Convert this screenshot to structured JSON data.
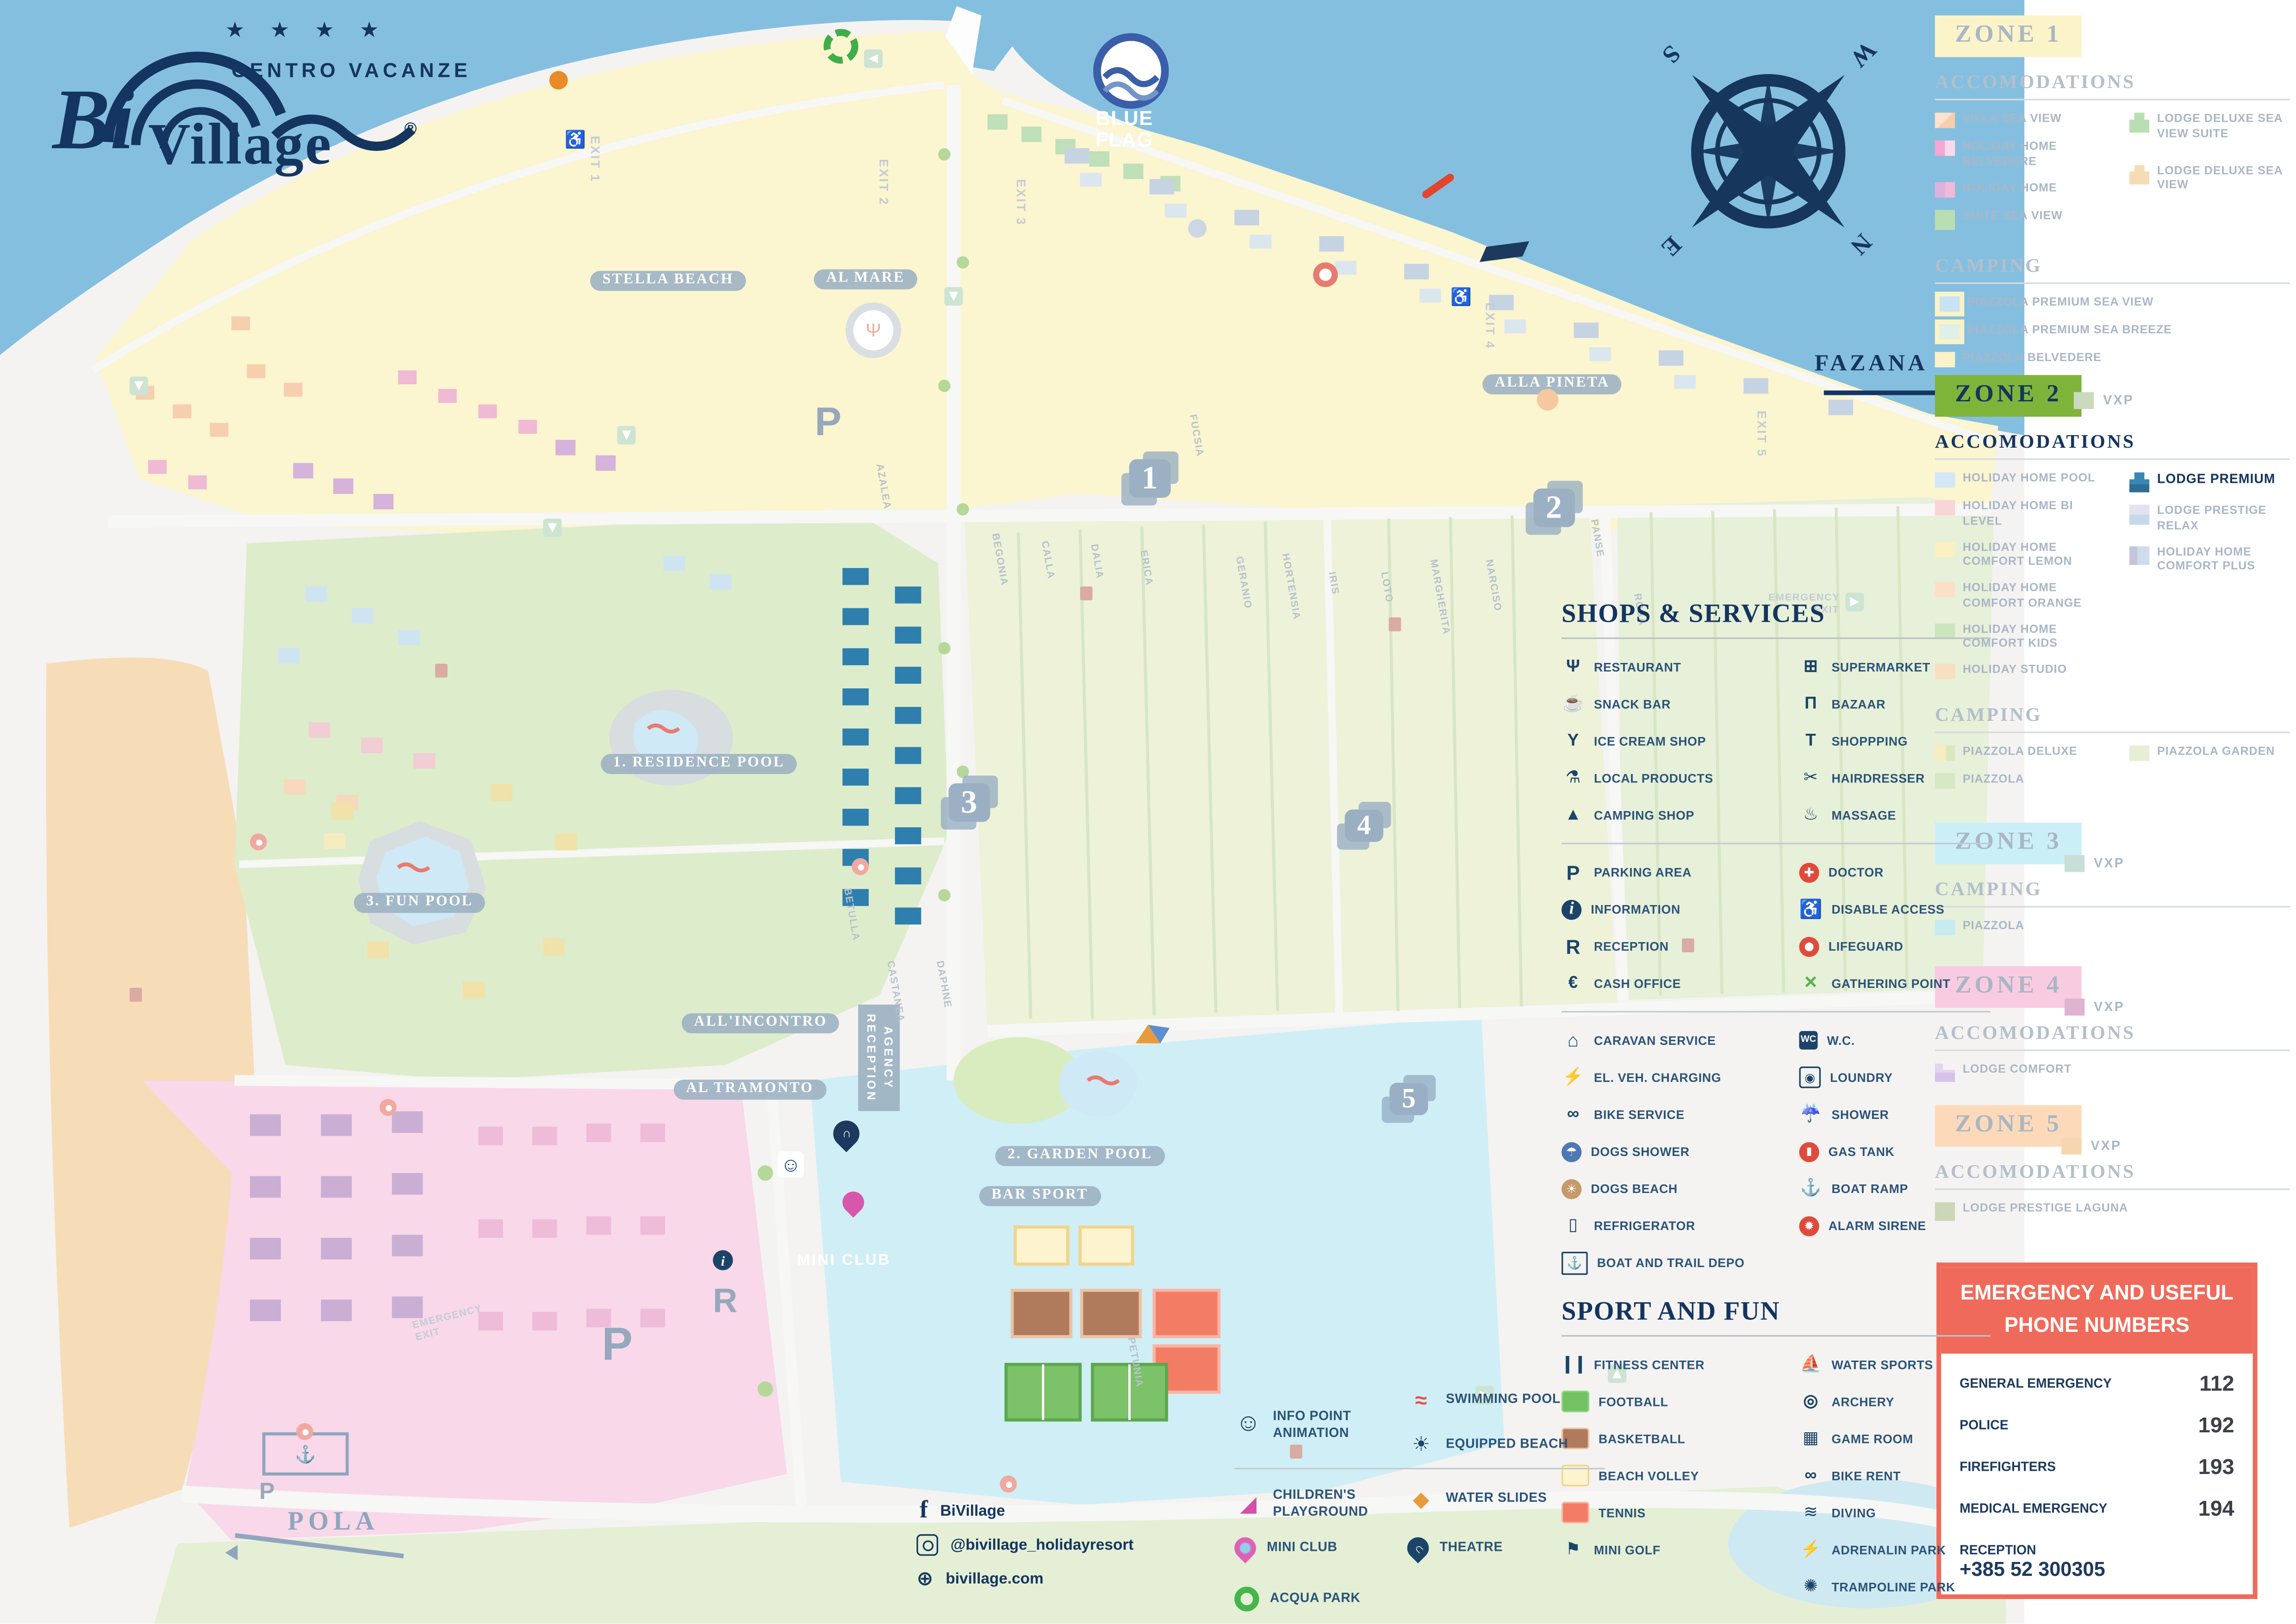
{
  "logo": {
    "bi": "Bi",
    "village": "Village",
    "reg": "®",
    "stars": "★ ★ ★ ★",
    "subtitle": "CENTRO VACANZE"
  },
  "blue_flag": {
    "line1": "BLUE",
    "line2": "FLAG"
  },
  "compass": {
    "n": "N",
    "s": "S",
    "e": "E",
    "w": "W"
  },
  "fazana": "FAZANA",
  "pola": "POLA",
  "map": {
    "labels": {
      "stella_beach": "STELLA BEACH",
      "al_mare": "AL MARE",
      "alla_pineta": "ALLA PINETA",
      "residence_pool": "1. RESIDENCE POOL",
      "garden_pool": "2. GARDEN POOL",
      "fun_pool": "3. FUN POOL",
      "all_incontro": "ALL'INCONTRO",
      "al_tramonto": "AL TRAMONTO",
      "bar_sport": "BAR SPORT",
      "mini_club": "MINI CLUB",
      "agency_line1": "AGENCY",
      "agency_line2": "RECEPTION"
    },
    "exits": [
      "EXIT 1",
      "EXIT 2",
      "EXIT 3",
      "EXIT 4",
      "EXIT 5"
    ],
    "emergency_exit_1": "EMERGENCY",
    "emergency_exit_2": "EXIT",
    "zone_markers": [
      "1",
      "2",
      "3",
      "4",
      "5"
    ],
    "letters": {
      "p": "P",
      "r": "R",
      "i": "i"
    },
    "icons": {
      "wheelchair": "♿",
      "smiley": "☺",
      "theatre": "∩",
      "depo": "⚓",
      "almare": "Ψ"
    },
    "streets": [
      "AZALEA",
      "BEGONIA",
      "CALLA",
      "DALIA",
      "ERICA",
      "FUCSIA",
      "GERANIO",
      "HORTENSIA",
      "IRIS",
      "LOTO",
      "MARGHERITA",
      "NARCISO",
      "PANSE",
      "ROSA",
      "BETULLA",
      "CASTANEA",
      "DAPHNE",
      "PETUNIA"
    ]
  },
  "zones": [
    {
      "title": "ZONE 1",
      "tstyle": "background:#fbf4c9;color:#a9b6c6",
      "h1": "ACCOMODATIONS",
      "h2": "CAMPING",
      "colA": [
        {
          "label": "VILLA SEA VIEW",
          "sw": "background:linear-gradient(135deg,#fbe3d0 50%,#f6cfae 50%)"
        },
        {
          "label": "HOLIDAY HOME BELVEDERE",
          "sw": "background:linear-gradient(90deg,#f4a7d4 50%,#fbd9ec 50%)"
        },
        {
          "label": "HOLIDAY HOME",
          "sw": "background:linear-gradient(90deg,#d9b3dd 50%,#f2b9d8 50%)"
        },
        {
          "label": "SUITE SEA VIEW",
          "sw": "background:#b9deb3;height:13px"
        }
      ],
      "colB": [
        {
          "label": "LODGE DELUXE SEA VIEW SUITE",
          "sw": "background:#b9deb3;height:13px;clip-path:polygon(25% 0,75% 0,75% 35%,100% 35%,100% 100%,0 100%,0 35%,25% 35%)"
        },
        {
          "label": "LODGE DELUXE SEA VIEW",
          "sw": "background:#f6dcb4;height:13px;clip-path:polygon(25% 0,75% 0,75% 35%,100% 35%,100% 100%,0 100%,0 35%,25% 35%)"
        }
      ],
      "campA": [
        {
          "label": "PIAZZOLA PREMIUM SEA VIEW",
          "sw": "background:#c9e3f2;box-shadow:0 0 0 3px #faf3c8;margin-left:3px"
        },
        {
          "label": "PIAZZOLA PREMIUM SEA BREEZE",
          "sw": "background:#e0efe7;box-shadow:0 0 0 3px #faf3c8;margin-left:3px"
        },
        {
          "label": "PIAZZOLA BELVEDERE",
          "sw": "background:#faf3c8"
        }
      ]
    },
    {
      "title": "ZONE 2",
      "tstyle": "background:#7fb43b;color:#14355f",
      "vxp": "VXP",
      "vxp_sw": "background:#cbd9bd",
      "h1": "ACCOMODATIONS",
      "h2": "CAMPING",
      "colA": [
        {
          "label": "HOLIDAY HOME POOL",
          "sw": "background:#d3e8f6"
        },
        {
          "label": "HOLIDAY HOME BI LEVEL",
          "sw": "background:#f6d6d6"
        },
        {
          "label": "HOLIDAY HOME COMFORT LEMON",
          "sw": "background:#f9f1c4"
        },
        {
          "label": "HOLIDAY HOME COMFORT ORANGE",
          "sw": "background:#fce0c6"
        },
        {
          "label": "HOLIDAY HOME COMFORT KIDS",
          "sw": "background:#cbe5bd"
        },
        {
          "label": "HOLIDAY STUDIO",
          "sw": "background:#f8dfc2"
        }
      ],
      "colB": [
        {
          "label": "LODGE PREMIUM",
          "lstyle": "color:#14355f;font-size:8.5px",
          "sw": "background:linear-gradient(#3787b4 60%,#2d6f94 60%);height:13px;clip-path:polygon(25% 0,75% 0,75% 35%,100% 35%,100% 100%,0 100%,0 35%,25% 35%)"
        },
        {
          "label": "LODGE PRESTIGE RELAX",
          "sw": "background:linear-gradient(#e2e2f0 50%,#c6d9e8 50%);height:13px"
        },
        {
          "label": "HOLIDAY HOME COMFORT PLUS",
          "sw": "background:linear-gradient(90deg,#c5c5da 40%,#cfdcec 40%);height:12px"
        }
      ],
      "campA": [
        {
          "label": "PIAZZOLA DELUXE",
          "sw": "background:linear-gradient(90deg,#f7edc0 55%,#d8e9c0 55%)"
        },
        {
          "label": "PIAZZOLA",
          "sw": "background:#d5e8c3"
        }
      ],
      "campB": [
        {
          "label": "PIAZZOLA GARDEN",
          "sw": "background:#e6efd4"
        }
      ]
    },
    {
      "title": "ZONE 3",
      "tstyle": "background:#cbeff6;color:#a9b6c6",
      "vxp": "VXP",
      "vxp_sw": "background:#c7ded9",
      "h2": "CAMPING",
      "campA": [
        {
          "label": "PIAZZOLA",
          "sw": "background:#c6ebf1"
        }
      ]
    },
    {
      "title": "ZONE 4",
      "tstyle": "background:#f9cbe1;color:#a9b6c6",
      "vxp": "VXP",
      "vxp_sw": "background:#dfb3d2",
      "h1": "ACCOMODATIONS",
      "colA": [
        {
          "label": "LODGE COMFORT",
          "sw": "background:linear-gradient(#e4d4ee 50%,#d6c2e8 50%);height:12px;clip-path:polygon(0 0,40% 0,40% 35%,100% 35%,100% 100%,0 100%)"
        }
      ]
    },
    {
      "title": "ZONE 5",
      "tstyle": "background:#fcdab9;color:#a9b6c6",
      "vxp": "VXP",
      "vxp_sw": "background:#f6d6ae",
      "h1": "ACCOMODATIONS",
      "colA": [
        {
          "label": "LODGE PRESTIGE LAGUNA",
          "sw": "background:#ccd6b8;height:12px"
        }
      ]
    }
  ],
  "services": {
    "title": "SHOPS & SERVICES",
    "g1a": [
      {
        "label": "RESTAURANT",
        "glyph": "Ψ",
        "ic": "font-weight:700"
      },
      {
        "label": "SNACK BAR",
        "glyph": "☕"
      },
      {
        "label": "ICE CREAM SHOP",
        "glyph": "Y",
        "ic": "font-weight:900"
      },
      {
        "label": "LOCAL PRODUCTS",
        "glyph": "⚗"
      },
      {
        "label": "CAMPING SHOP",
        "glyph": "▲"
      }
    ],
    "g1b": [
      {
        "label": "SUPERMARKET",
        "glyph": "⊞",
        "ic": "font-weight:700"
      },
      {
        "label": "BAZAAR",
        "glyph": "Π",
        "ic": "font-weight:900"
      },
      {
        "label": "SHOPPPING",
        "glyph": "T",
        "ic": "font-weight:900"
      },
      {
        "label": "HAIRDRESSER",
        "glyph": "✂"
      },
      {
        "label": "MASSAGE",
        "glyph": "♨"
      }
    ],
    "g2a": [
      {
        "label": "PARKING AREA",
        "glyph": "P",
        "ic": "font-weight:900;font-size:13px"
      },
      {
        "label": "INFORMATION",
        "glyph": "i",
        "ic": "background:#1c4468;color:#fff;border-radius:50%;font-family:'Liberation Serif',serif;font-style:italic;font-weight:700;width:13px;flex-basis:13px"
      },
      {
        "label": "RECEPTION",
        "glyph": "R",
        "ic": "font-weight:900;font-size:13px"
      },
      {
        "label": "CASH OFFICE",
        "glyph": "€",
        "ic": "font-weight:900"
      }
    ],
    "g2b": [
      {
        "label": "DOCTOR",
        "glyph": "✚",
        "ic": "background:#df4b3b;color:#fff;border-radius:50%;font-size:8px;width:13px;flex-basis:13px"
      },
      {
        "label": "DISABLE ACCESS",
        "glyph": "♿",
        "ic": "font-size:12px"
      },
      {
        "label": "LIFEGUARD",
        "glyph": "",
        "ic": "background:radial-gradient(#ffffff 0 30%,#df4b3b 31%);border-radius:50%;width:13px;flex-basis:13px;height:13px"
      },
      {
        "label": "GATHERING POINT",
        "glyph": "✕",
        "ic": "color:#57b44c;font-weight:900"
      }
    ],
    "g3a": [
      {
        "label": "CARAVAN SERVICE",
        "glyph": "⌂",
        "ic": "font-weight:900;font-size:12px"
      },
      {
        "label": "EL. VEH. CHARGING",
        "glyph": "⚡"
      },
      {
        "label": "BIKE SERVICE",
        "glyph": "∞",
        "ic": "font-weight:900"
      },
      {
        "label": "DOGS SHOWER",
        "glyph": "☂",
        "ic": "background:#5077b4;color:#fff;border-radius:50%;font-size:8px;width:13px;flex-basis:13px;height:13px"
      },
      {
        "label": "DOGS BEACH",
        "glyph": "☀",
        "ic": "background:#c79a6b;color:#fff;border-radius:50%;font-size:8px;width:13px;flex-basis:13px;height:13px"
      },
      {
        "label": "REFRIGERATOR",
        "glyph": "▯"
      },
      {
        "label": "BOAT AND TRAIL DEPO",
        "glyph": "⚓",
        "ic": "border:1.5px solid #1c4468;font-size:8px;border-radius:1px"
      }
    ],
    "g3b": [
      {
        "label": "W.C.",
        "glyph": "WC",
        "ic": "background:#1c4468;color:#fff;font-size:6px;font-weight:700;border-radius:2px;width:12px;flex-basis:12px;height:12px"
      },
      {
        "label": "LOUNDRY",
        "glyph": "◉",
        "ic": "border:1.5px solid #1c4468;font-size:8px;border-radius:2px;width:12px;flex-basis:12px;height:12px"
      },
      {
        "label": "SHOWER",
        "glyph": "☔"
      },
      {
        "label": "GAS TANK",
        "glyph": "▮",
        "ic": "background:#df4b3b;color:#fff;border-radius:50%;font-size:7px;width:13px;flex-basis:13px;height:13px"
      },
      {
        "label": "BOAT RAMP",
        "glyph": "⚓"
      },
      {
        "label": "ALARM SIRENE",
        "glyph": "✹",
        "ic": "background:#df4b3b;color:#fff;border-radius:50%;font-size:8px;width:13px;flex-basis:13px;height:13px"
      }
    ]
  },
  "sport": {
    "title": "SPORT AND FUN",
    "a": [
      {
        "label": "FITNESS CENTER",
        "glyph": "❙❙",
        "ic": "font-weight:900;letter-spacing:-1px"
      },
      {
        "label": "FOOTBALL",
        "glyph": "",
        "ic": "background:#72c162;border:1.5px solid #8ed47f;border-radius:2px;width:16px;flex-basis:16px;height:12px"
      },
      {
        "label": "BASKETBALL",
        "glyph": "",
        "ic": "background:#b07a5c;border:1.5px solid #eac3a6;border-radius:2px;width:16px;flex-basis:16px;height:12px"
      },
      {
        "label": "BEACH VOLLEY",
        "glyph": "",
        "ic": "background:#fdf3cf;border:1.5px solid #f0d488;border-radius:2px;width:16px;flex-basis:16px;height:12px"
      },
      {
        "label": "TENNIS",
        "glyph": "",
        "ic": "background:#f37d64;border:1.5px solid #f8b5a5;border-radius:2px;width:16px;flex-basis:16px;height:12px"
      },
      {
        "label": "MINI GOLF",
        "glyph": "⚑"
      }
    ],
    "b": [
      {
        "label": "WATER SPORTS",
        "glyph": "⛵"
      },
      {
        "label": "ARCHERY",
        "glyph": "◎",
        "ic": "font-weight:900"
      },
      {
        "label": "GAME ROOM",
        "glyph": "▦"
      },
      {
        "label": "BIKE RENT",
        "glyph": "∞",
        "ic": "font-weight:900"
      },
      {
        "label": "DIVING",
        "glyph": "≋"
      },
      {
        "label": "ADRENALIN PARK",
        "glyph": "⚡"
      },
      {
        "label": "TRAMPOLINE PARK",
        "glyph": "✺"
      }
    ]
  },
  "fun": {
    "a": [
      {
        "label": "INFO POINT ANIMATION",
        "glyph": "☺",
        "ic": "font-size:16px"
      },
      {
        "label": "CHILDREN'S PLAYGROUND",
        "glyph": "◢",
        "ic": "color:#d64fa8;font-size:14px"
      },
      {
        "label": "MINI CLUB",
        "glyph": "",
        "ic": "background:radial-gradient(#8fd0e8 0 3px,#e060b8 4px);border-radius:50% 50% 50% 0;transform:rotate(-45deg);width:14px;flex-basis:14px;height:14px"
      },
      {
        "label": "ACQUA PARK",
        "glyph": "",
        "ic": "border:4px solid #45b64a;border-radius:50%;width:8px;flex-basis:8px;height:8px"
      }
    ],
    "b": [
      {
        "label": "SWIMMING POOL",
        "glyph": "≈",
        "ic": "color:#e05448;font-weight:900;font-size:14px"
      },
      {
        "label": "EQUIPPED BEACH",
        "glyph": "☀"
      },
      {
        "label": "WATER SLIDES",
        "glyph": "◆",
        "ic": "color:#e89b3c;font-size:14px"
      },
      {
        "label": "THEATRE",
        "glyph": "∩",
        "ic": "background:#1c4468;color:#fff;border-radius:50% 50% 50% 0;transform:rotate(-45deg);font-size:8px;width:14px;flex-basis:14px;height:14px"
      }
    ]
  },
  "emergency": {
    "title1": "EMERGENCY AND USEFUL",
    "title2": "PHONE NUMBERS",
    "rows": [
      {
        "label": "GENERAL EMERGENCY",
        "number": "112"
      },
      {
        "label": "POLICE",
        "number": "192"
      },
      {
        "label": "FIREFIGHTERS",
        "number": "193"
      },
      {
        "label": "MEDICAL EMERGENCY",
        "number": "194"
      }
    ],
    "reception_label": "RECEPTION",
    "reception_number": "+385 52 300305"
  },
  "social": {
    "fb_glyph": "f",
    "facebook": "BiVillage",
    "instagram": "@bivillage_holidayresort",
    "globe_glyph": "⊕",
    "web": "bivillage.com"
  }
}
